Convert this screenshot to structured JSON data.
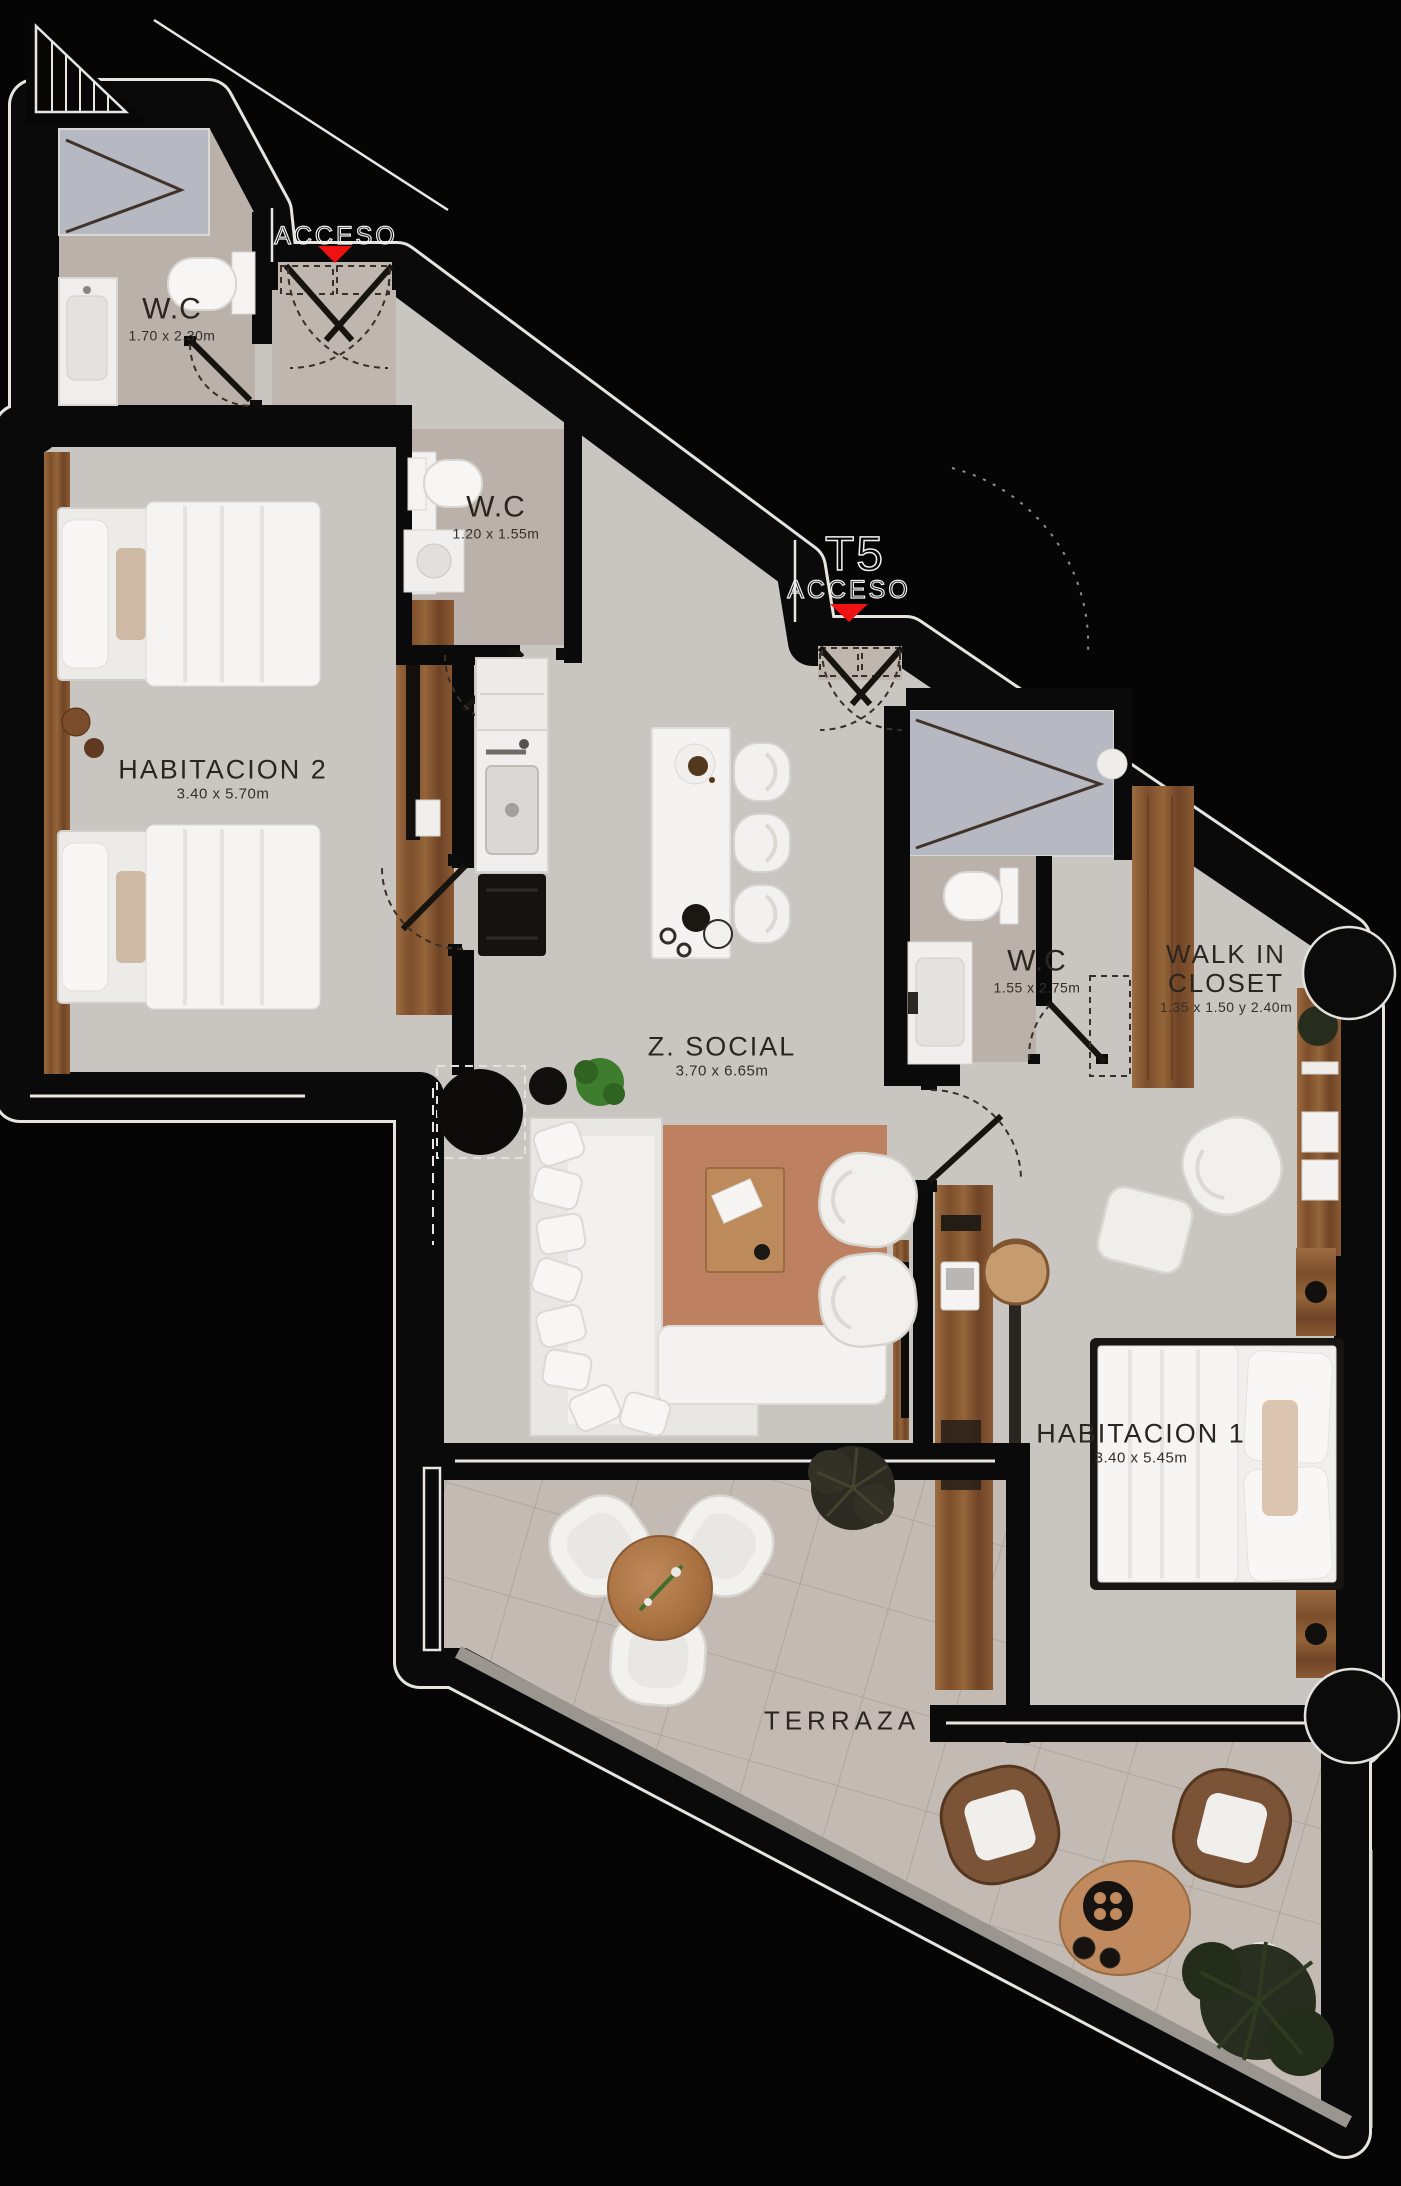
{
  "plan": {
    "unit": "T5",
    "entry_label_top": "ACCESO",
    "entry_label_unit": "ACCESO",
    "rooms": {
      "wc1": {
        "title": "W.C",
        "dims": "1.70 x 2.30m"
      },
      "wc2": {
        "title": "W.C",
        "dims": "1.20 x 1.55m"
      },
      "hab2": {
        "title": "HABITACION 2",
        "dims": "3.40 x 5.70m"
      },
      "zsocial": {
        "title": "Z. SOCIAL",
        "dims": "3.70 x 6.65m"
      },
      "wc3": {
        "title": "W.C",
        "dims": "1.55 x 2.75m"
      },
      "walkin": {
        "title1": "WALK IN",
        "title2": "CLOSET",
        "dims": "1.35 x 1.50 y 2.40m"
      },
      "hab1": {
        "title": "HABITACION 1",
        "dims": "3.40 x 5.45m"
      },
      "terraza": {
        "title": "TERRAZA"
      }
    },
    "colors": {
      "accent_red": "#ee1212",
      "wall": "#0a0a0a",
      "floor": "#c9c6c2",
      "bath_floor": "#b9b1aa",
      "shower_tile": "#b6b9c1",
      "wood": "#8a5a36",
      "rug": "#bd8162"
    }
  }
}
